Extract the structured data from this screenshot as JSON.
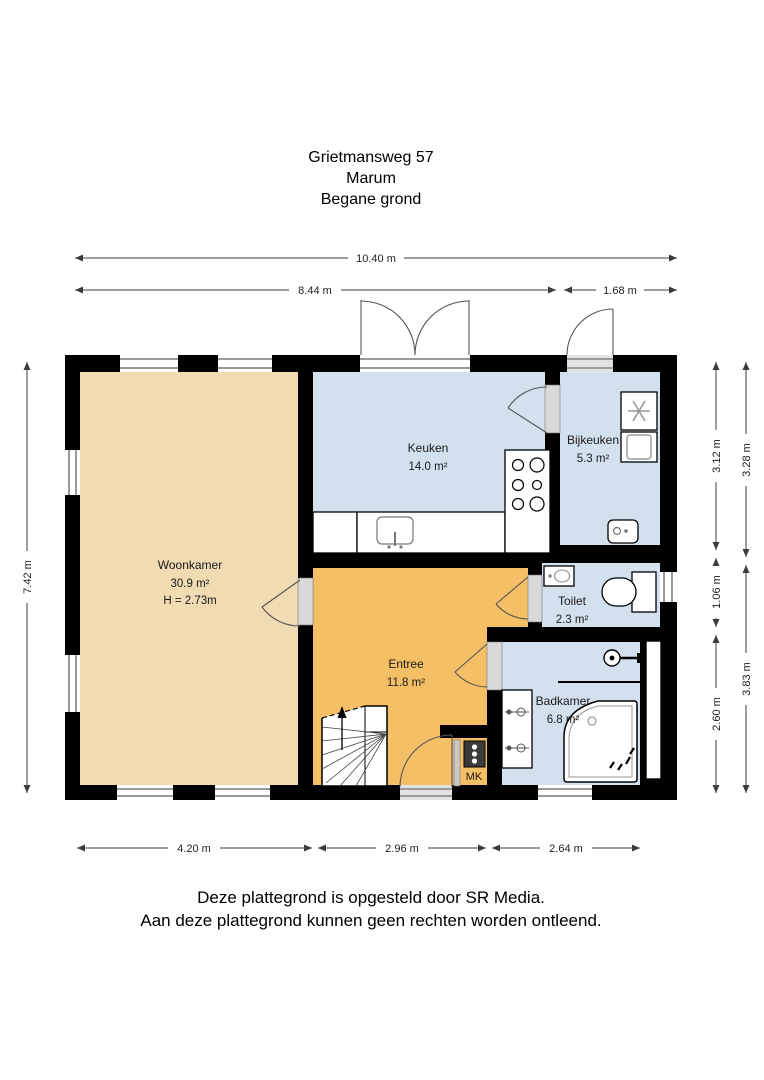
{
  "title": {
    "address": "Grietmansweg 57",
    "city": "Marum",
    "floor": "Begane grond"
  },
  "rooms": {
    "woonkamer": {
      "name": "Woonkamer",
      "area": "30.9 m²",
      "height": "H = 2.73m"
    },
    "keuken": {
      "name": "Keuken",
      "area": "14.0 m²"
    },
    "bijkeuken": {
      "name": "Bijkeuken",
      "area": "5.3 m²"
    },
    "toilet": {
      "name": "Toilet",
      "area": "2.3 m²"
    },
    "entree": {
      "name": "Entree",
      "area": "11.8 m²"
    },
    "badkamer": {
      "name": "Badkamer",
      "area": "6.8 m²"
    },
    "meterkast": {
      "label": "MK"
    }
  },
  "dimensions": {
    "top_total": "10.40 m",
    "top_left": "8.44 m",
    "top_right": "1.68 m",
    "left_total": "7.42 m",
    "right_inner_top": "3.12 m",
    "right_inner_mid": "1.06 m",
    "right_inner_bottom": "2.60 m",
    "right_outer_top": "3.28 m",
    "right_outer_bottom": "3.83 m",
    "bottom_left": "4.20 m",
    "bottom_mid": "2.96 m",
    "bottom_right": "2.64 m"
  },
  "footer": {
    "line1": "Deze plattegrond is opgesteld door SR Media.",
    "line2": "Aan deze plattegrond kunnen geen rechten worden ontleend."
  },
  "colors": {
    "wall": "#000000",
    "living_room_floor": "#F0DBB2",
    "hallway_floor": "#F5BF66",
    "wet_room_floor": "#D3E0EE",
    "window_frame": "#9A9A9A",
    "dimension_line": "#3C3C3C",
    "meter_panel": "#3B3B3B"
  }
}
